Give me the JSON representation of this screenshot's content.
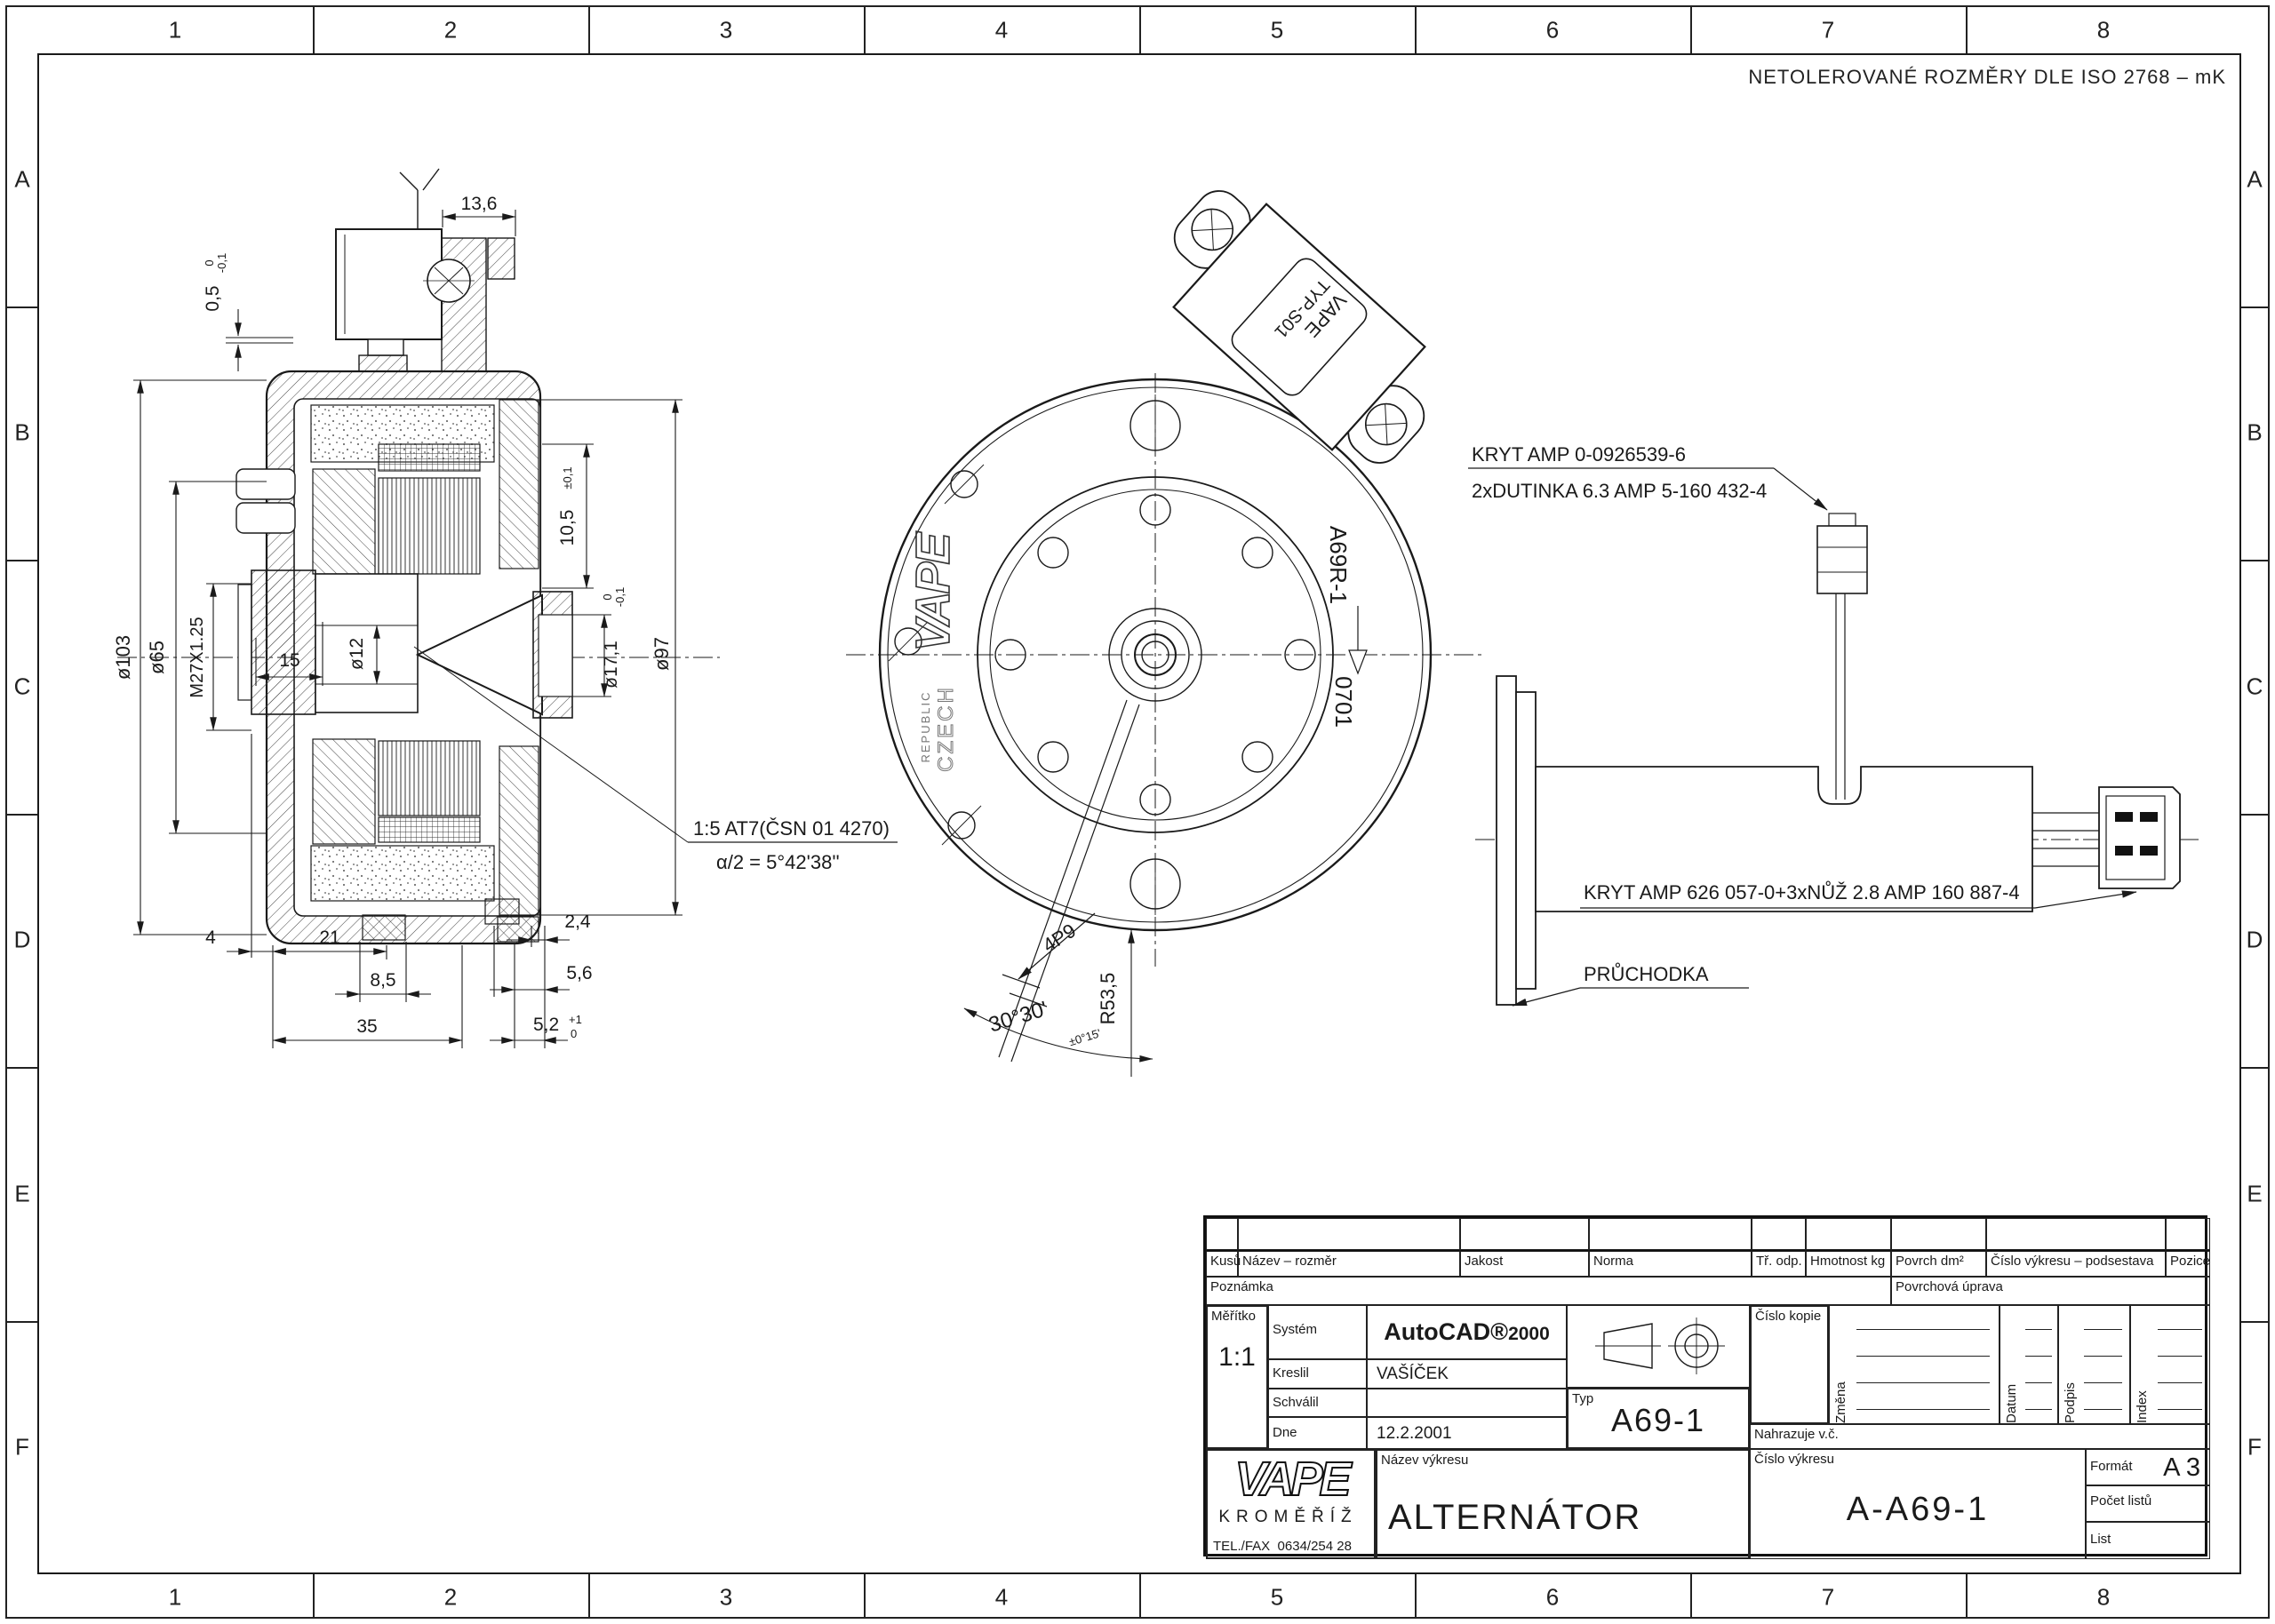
{
  "page": {
    "tolerance_note": "NETOLEROVANÉ ROZMĚRY DLE ISO 2768 – mK",
    "grid": {
      "cols": [
        "1",
        "2",
        "3",
        "4",
        "5",
        "6",
        "7",
        "8"
      ],
      "rows": [
        "A",
        "B",
        "C",
        "D",
        "E",
        "F"
      ]
    }
  },
  "section": {
    "dims": {
      "d13_6": "13,6",
      "d0_5": "0,5",
      "d0_5_hi": "0",
      "d0_5_lo": "-0,1",
      "d103": "ø103",
      "d65": "ø65",
      "m27": "M27X1.25",
      "d15": "15",
      "d12": "ø12",
      "d10_5": "10,5",
      "d10_5_tol": "±0,1",
      "d17_1": "ø17,1",
      "d17_hi": "0",
      "d17_lo": "-0,1",
      "d97": "ø97",
      "d4": "4",
      "d21": "21",
      "d8_5": "8,5",
      "d35": "35",
      "d2_4": "2,4",
      "d5_6": "5,6",
      "d5_2": "5,2",
      "d5_2_hi": "+1",
      "d5_2_lo": "0"
    },
    "taper_note1": "1:5 AT7(ČSN 01 4270)",
    "taper_note2": "α/2 = 5°42'38''"
  },
  "front": {
    "logo": "VAPE",
    "logo_sub1": "CZECH",
    "logo_sub2": "REPUBLIC",
    "part_code": "A69R-1",
    "cast_code": "0701",
    "regulator": {
      "brand": "VAPE",
      "type": "TYP-S01"
    },
    "dims": {
      "key": "4P9",
      "radius": "R53,5",
      "angle": "30°30'",
      "angle_tol": "±0°15'"
    }
  },
  "callouts": {
    "cover1_l1": "KRYT AMP 0-0926539-6",
    "cover1_l2": "2xDUTINKA 6.3 AMP 5-160 432-4",
    "cover2": "KRYT AMP 626 057-0+3xNŮŽ 2.8 AMP 160 887-4",
    "grommet": "PRŮCHODKA"
  },
  "tb": {
    "headers": [
      "Kusů",
      "Název – rozměr",
      "Jakost",
      "Norma",
      "Tř. odp.",
      "Hmotnost kg",
      "Povrch dm²",
      "Číslo výkresu – podsestava",
      "Pozice"
    ],
    "note": "Poznámka",
    "surface": "Povrchová úprava",
    "scale_label": "Měřítko",
    "scale": "1:1",
    "system_label": "Systém",
    "system": "AutoCAD®",
    "system2": "2000",
    "drawn_label": "Kreslil",
    "drawn": "VAŠÍČEK",
    "approved_label": "Schválil",
    "approved": "",
    "date_label": "Dne",
    "date": "12.2.2001",
    "typ_label": "Typ",
    "typ": "A69-1",
    "copy_label": "Číslo kopie",
    "rev_cols": [
      "Změna",
      "Datum",
      "Podpis",
      "Index"
    ],
    "replaces_label": "Nahrazuje v.č.",
    "dwg_label": "Číslo výkresu",
    "dwg": "A-A69-1",
    "name_label": "Název výkresu",
    "name": "ALTERNÁTOR",
    "logo": "VAPE",
    "city": "KROMĚŘÍŽ",
    "tel_label": "TEL./FAX",
    "tel": "0634/254 28",
    "format_label": "Formát",
    "format": "A 3",
    "sheets_label": "Počet listů",
    "list_label": "List"
  }
}
